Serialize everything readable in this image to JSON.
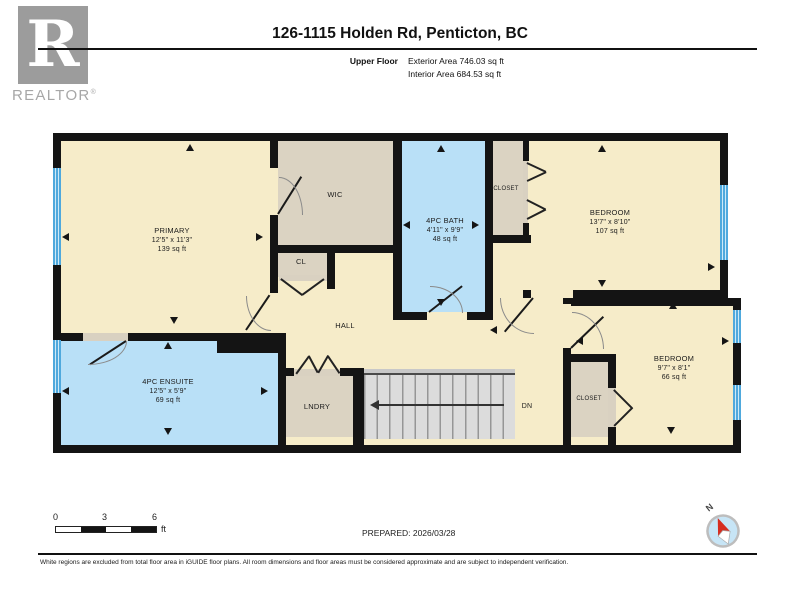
{
  "header": {
    "title": "126-1115 Holden Rd, Penticton, BC",
    "floor_label": "Upper Floor",
    "exterior_area": "Exterior Area 746.03 sq ft",
    "interior_area": "Interior Area 684.53 sq ft"
  },
  "logo": {
    "letter": "R",
    "brand": "REALTOR",
    "registered": "®"
  },
  "rooms": {
    "primary": {
      "name": "PRIMARY",
      "dims": "12'5\" x 11'3\"",
      "area": "139 sq ft"
    },
    "wic": {
      "name": "WIC"
    },
    "cl": {
      "name": "CL"
    },
    "bath": {
      "name": "4PC BATH",
      "dims": "4'11\" x 9'9\"",
      "area": "48 sq ft"
    },
    "closet_top": {
      "name": "CLOSET"
    },
    "bedroom_top": {
      "name": "BEDROOM",
      "dims": "13'7\" x 8'10\"",
      "area": "107 sq ft"
    },
    "hall": {
      "name": "HALL"
    },
    "ensuite": {
      "name": "4PC ENSUITE",
      "dims": "12'5\" x 5'9\"",
      "area": "69 sq ft"
    },
    "lndry": {
      "name": "LNDRY"
    },
    "bedroom_bottom": {
      "name": "BEDROOM",
      "dims": "9'7\" x 8'1\"",
      "area": "66 sq ft"
    },
    "closet_bottom": {
      "name": "CLOSET"
    },
    "stairs": {
      "direction_label": "DN"
    }
  },
  "scale_bar": {
    "tick_0": "0",
    "tick_3": "3",
    "tick_6": "6",
    "unit": "ft"
  },
  "prepared": "PREPARED: 2026/03/28",
  "compass": {
    "north_label": "N"
  },
  "footer": {
    "disclaimer": "White regions are excluded from total floor area in iGUIDE floor plans. All room dimensions and floor areas must be considered approximate and are subject to independent verification."
  },
  "colors": {
    "floor_cream": "#F6ECC9",
    "floor_gray": "#DBD3C2",
    "floor_blue": "#B9E0F7",
    "window_blue": "#4FA9DD",
    "wall_black": "#141414",
    "stairs_gray": "#DCDCDC"
  }
}
